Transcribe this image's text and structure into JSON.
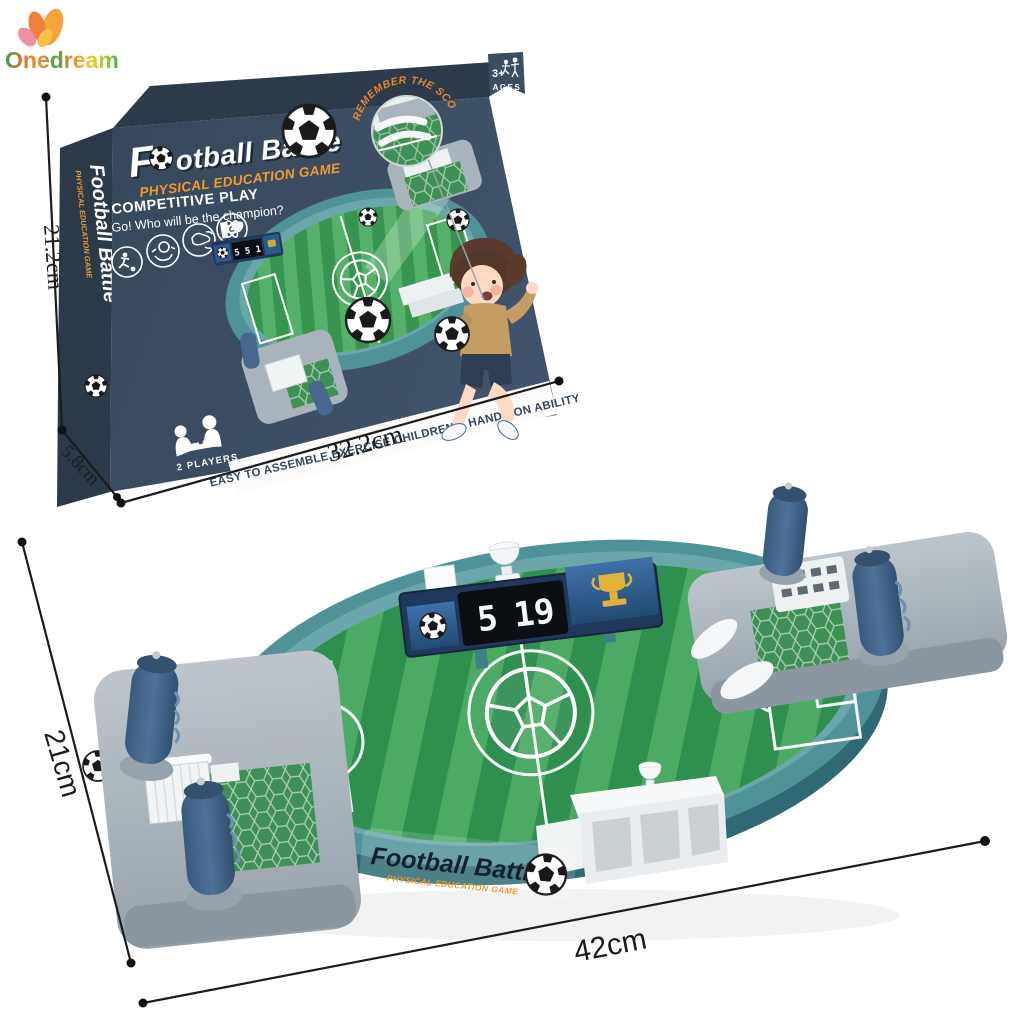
{
  "logo": {
    "text": "Onedream"
  },
  "box": {
    "title_full": "Football Battle",
    "title_f": "F",
    "title_rest": "otball Battle",
    "subtitle": "PHYSICAL EDUCATION GAME",
    "competitive_play": "COMPETITIVE PLAY",
    "tagline": "Go! Who will be the champion?",
    "ages_number": "3+",
    "ages_label": "AGES",
    "magnifier_caption": "REMEMBER THE SCORE",
    "easy_note": "EASY TO ASSEMBLE,EXERCISE CHILDREN'S HANDS-ON ABILITY",
    "players_label": "2 PLAYERS",
    "art_score": "5 5 1",
    "spine_title": "Football Battle",
    "spine_subtitle": "PHYSICAL EDUCATION GAME"
  },
  "game": {
    "score_left": "5",
    "score_right": "19",
    "sticker_title": "Football Battle",
    "sticker_subtitle": "PHYSICAL EDUCATION GAME"
  },
  "dimensions": {
    "box_height": "21.2cm",
    "box_depth": "5.8cm",
    "box_width": "32.2cm",
    "game_depth": "21cm",
    "game_width": "42cm"
  },
  "icons": {
    "logo_mark": "flower-flame-icon",
    "ages_tab": "ages-3plus-ribbon",
    "feature_circles": [
      "player-kick-icon",
      "hands-ball-icon",
      "flick-hand-icon",
      "atom-icon"
    ],
    "players_badge": "two-players-table-icon",
    "scoreboard_left": "soccer-ball-icon",
    "scoreboard_right": "gold-trophy-icon"
  },
  "colors": {
    "box_navy": "#3c4d61",
    "box_navy_dark": "#2c3a4a",
    "accent_orange": "#ef9a2e",
    "teal_body": "#4f9398",
    "field_green_dark": "#2e8f4f",
    "field_green_light": "#4daa64",
    "plastic_gray": "#a9b3bb",
    "handle_blue": "#45688c"
  }
}
